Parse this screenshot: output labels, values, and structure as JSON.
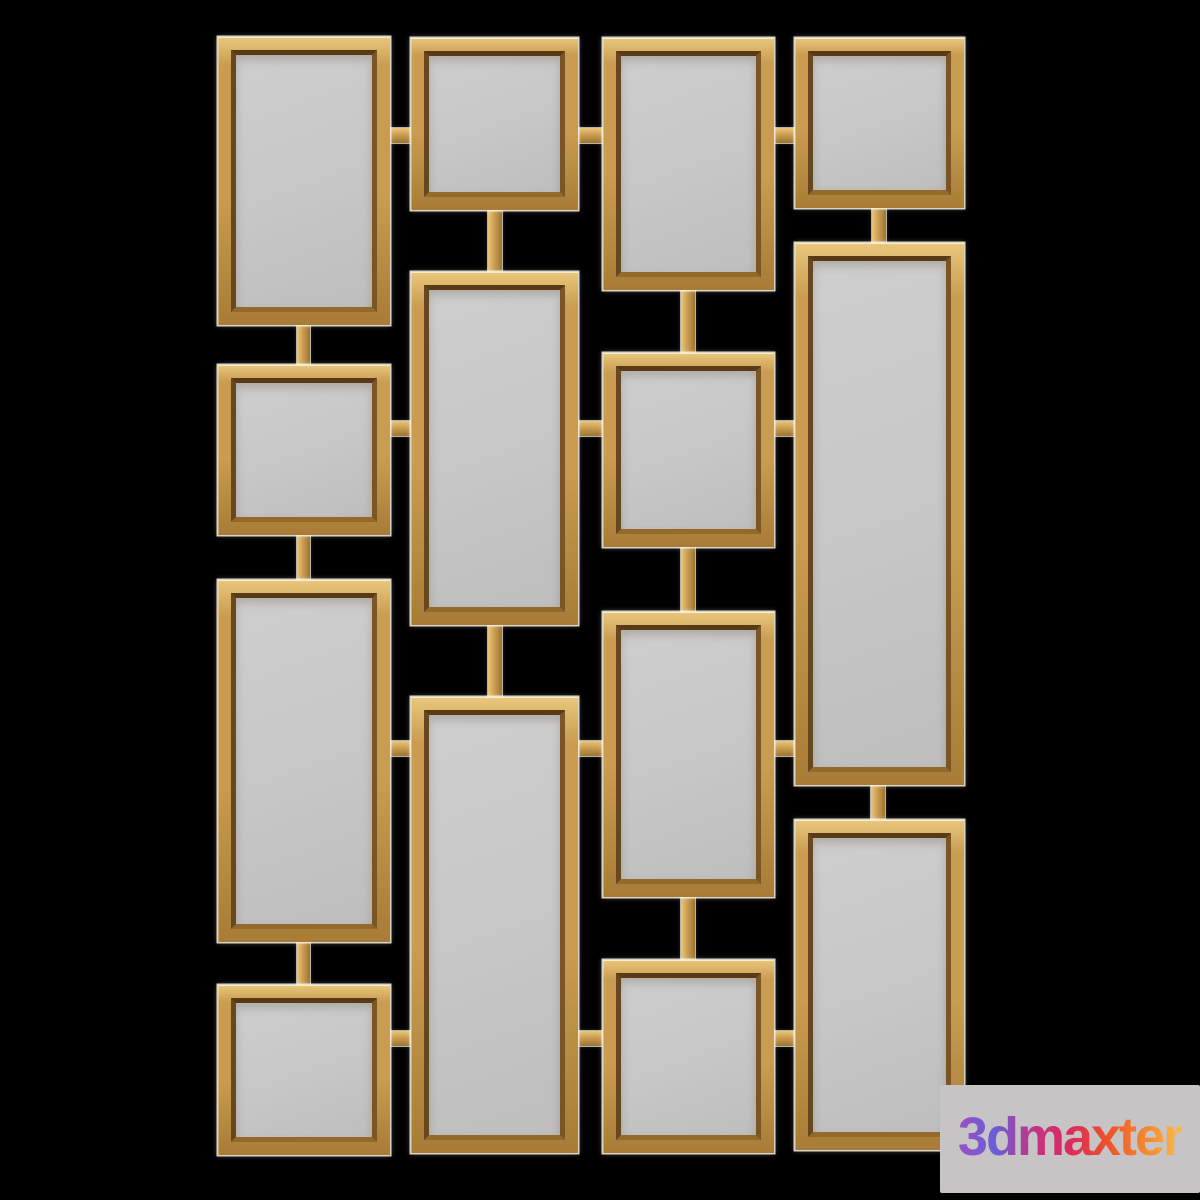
{
  "scene": {
    "description": "gold-framed decorative wall mirror set of 14 rectangular mirrors connected by bars, rendered on black",
    "background_color": "#000000",
    "colors": {
      "gold_face": "#C99C51",
      "gold_highlight": "#E9C77C",
      "gold_shadow": "#A87C36",
      "bevel": "#6B4718",
      "mirror_glass": "#C7C7C7",
      "edge_halo": "#F8F3E4"
    },
    "frames": [
      {
        "id": "col1-rect-top",
        "x": 218,
        "y": 37,
        "w": 172,
        "h": 288
      },
      {
        "id": "col1-square-2",
        "x": 218,
        "y": 365,
        "w": 172,
        "h": 170
      },
      {
        "id": "col1-rect-3",
        "x": 218,
        "y": 580,
        "w": 172,
        "h": 362
      },
      {
        "id": "col1-square-bottom",
        "x": 218,
        "y": 985,
        "w": 172,
        "h": 170
      },
      {
        "id": "col2-square-top",
        "x": 411,
        "y": 38,
        "w": 167,
        "h": 172
      },
      {
        "id": "col2-rect-middle",
        "x": 411,
        "y": 272,
        "w": 167,
        "h": 353
      },
      {
        "id": "col2-rect-bottom",
        "x": 411,
        "y": 697,
        "w": 167,
        "h": 456
      },
      {
        "id": "col3-rect-top",
        "x": 603,
        "y": 38,
        "w": 171,
        "h": 252
      },
      {
        "id": "col3-square-2",
        "x": 603,
        "y": 353,
        "w": 171,
        "h": 194
      },
      {
        "id": "col3-rect-3",
        "x": 603,
        "y": 612,
        "w": 171,
        "h": 285
      },
      {
        "id": "col3-square-bottom",
        "x": 603,
        "y": 960,
        "w": 171,
        "h": 193
      },
      {
        "id": "col4-square-top",
        "x": 795,
        "y": 38,
        "w": 169,
        "h": 170
      },
      {
        "id": "col4-rect-middle",
        "x": 795,
        "y": 243,
        "w": 169,
        "h": 542
      },
      {
        "id": "col4-rect-bottom",
        "x": 795,
        "y": 820,
        "w": 169,
        "h": 330
      }
    ],
    "connectors_vertical": [
      {
        "x": 297,
        "y": 323,
        "w": 13,
        "h": 44
      },
      {
        "x": 297,
        "y": 533,
        "w": 13,
        "h": 49
      },
      {
        "x": 297,
        "y": 940,
        "w": 13,
        "h": 47
      },
      {
        "x": 488,
        "y": 208,
        "w": 14,
        "h": 66
      },
      {
        "x": 488,
        "y": 623,
        "w": 14,
        "h": 76
      },
      {
        "x": 681,
        "y": 288,
        "w": 14,
        "h": 67
      },
      {
        "x": 681,
        "y": 545,
        "w": 14,
        "h": 69
      },
      {
        "x": 681,
        "y": 895,
        "w": 14,
        "h": 67
      },
      {
        "x": 872,
        "y": 206,
        "w": 14,
        "h": 39
      },
      {
        "x": 871,
        "y": 783,
        "w": 14,
        "h": 39
      }
    ],
    "connectors_horizontal": [
      {
        "x": 388,
        "y": 128,
        "w": 25,
        "h": 15
      },
      {
        "x": 576,
        "y": 128,
        "w": 29,
        "h": 15
      },
      {
        "x": 772,
        "y": 128,
        "w": 25,
        "h": 15
      },
      {
        "x": 388,
        "y": 421,
        "w": 25,
        "h": 15
      },
      {
        "x": 576,
        "y": 421,
        "w": 29,
        "h": 15
      },
      {
        "x": 772,
        "y": 421,
        "w": 25,
        "h": 15
      },
      {
        "x": 388,
        "y": 741,
        "w": 25,
        "h": 15
      },
      {
        "x": 576,
        "y": 741,
        "w": 29,
        "h": 15
      },
      {
        "x": 772,
        "y": 741,
        "w": 25,
        "h": 15
      },
      {
        "x": 388,
        "y": 1031,
        "w": 25,
        "h": 15
      },
      {
        "x": 576,
        "y": 1031,
        "w": 29,
        "h": 15
      },
      {
        "x": 772,
        "y": 1031,
        "w": 25,
        "h": 15
      }
    ]
  },
  "watermark": {
    "label": "3dmaxter",
    "box": {
      "x": 940,
      "y": 1085,
      "w": 260,
      "h": 108
    },
    "bg_color": "#C6C4C4",
    "text_gradient": [
      "#9C4EC5",
      "#6A5ED8",
      "#C23488",
      "#DC2A5B",
      "#ED512C",
      "#F5862F",
      "#FBBC4C"
    ]
  }
}
